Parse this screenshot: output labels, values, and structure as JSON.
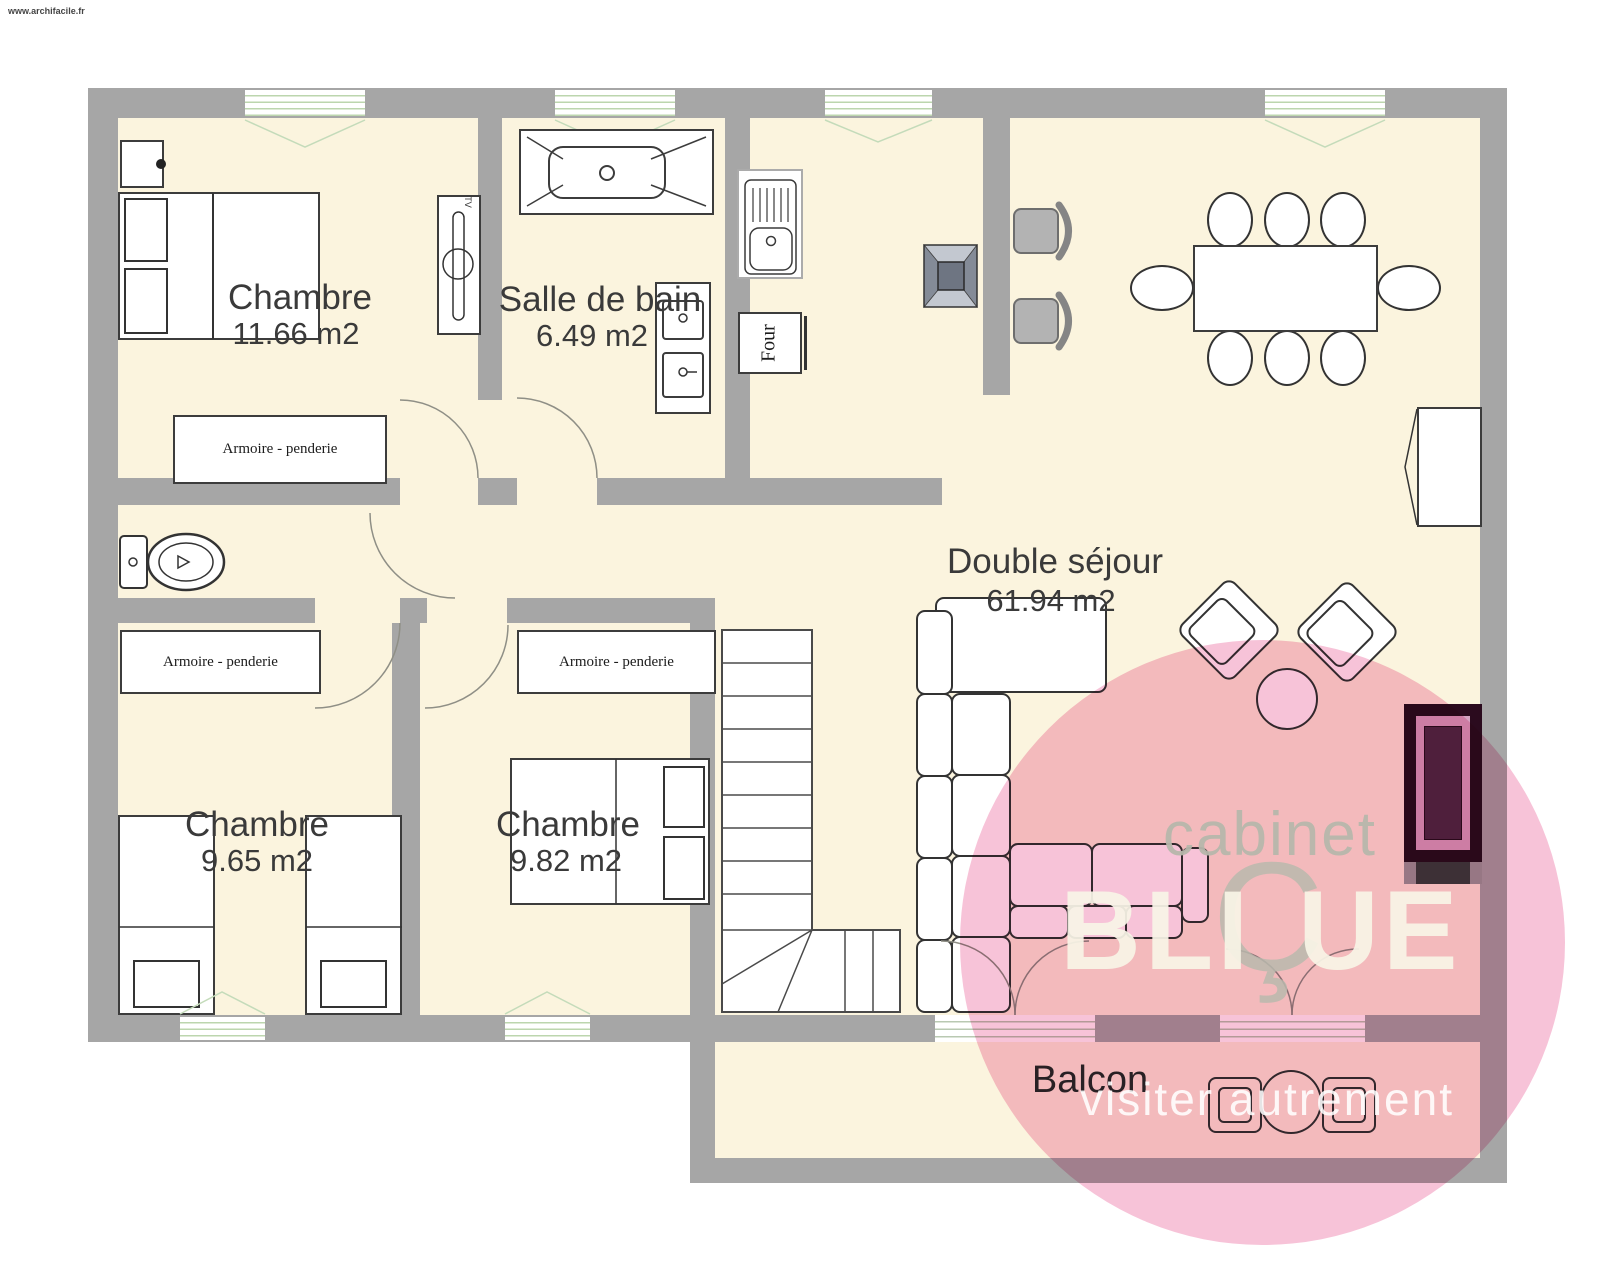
{
  "credit": "www.archifacile.fr",
  "rooms": [
    {
      "name": "Chambre",
      "area": "11.66 m2"
    },
    {
      "name": "Salle de bain",
      "area": "6.49 m2"
    },
    {
      "name": "Chambre",
      "area": "9.65 m2"
    },
    {
      "name": "Chambre",
      "area": "9.82 m2"
    },
    {
      "name": "Double séjour",
      "area": "61.94 m2"
    },
    {
      "name": "Balcon",
      "area": ""
    }
  ],
  "furniture_labels": {
    "wardrobe": "Armoire - penderie",
    "oven": "Four",
    "tv": "TV"
  },
  "watermark": {
    "brand_top": "cabinet",
    "logo_left": "BLI",
    "logo_mid": "Ç",
    "logo_right": "UE",
    "tagline": "visiter autrement",
    "circle_color": "#f7c3d8"
  },
  "colors": {
    "wall_gray": "#a6a6a6",
    "floor_cream": "#fbf4de",
    "watermark_pink": "#f7c3d8"
  }
}
